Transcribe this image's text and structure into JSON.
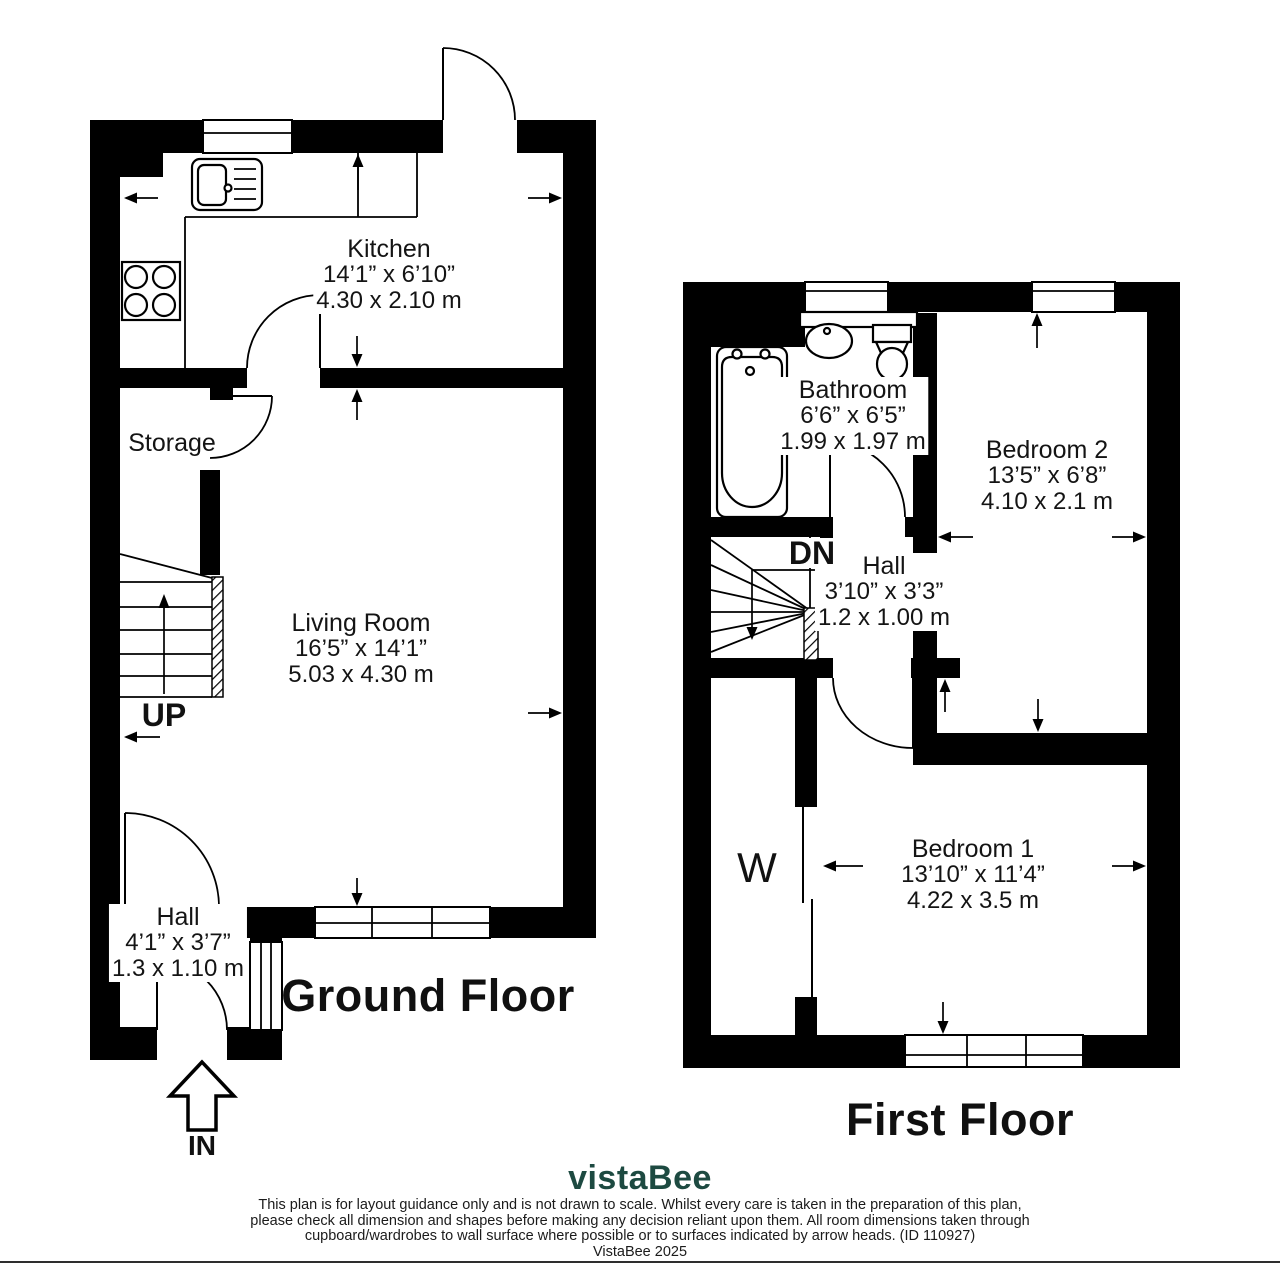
{
  "meta": {
    "background_color": "#ffffff",
    "wall_color": "#000000",
    "text_color": "#141414",
    "logo_color": "#1d4a41"
  },
  "ground_floor": {
    "title": "Ground Floor",
    "stairs_label": "UP",
    "entrance_label": "IN",
    "rooms": {
      "kitchen": {
        "name": "Kitchen",
        "imperial": "14’1” x 6’10”",
        "metric": "4.30 x 2.10 m"
      },
      "storage": {
        "name": "Storage"
      },
      "living_room": {
        "name": "Living Room",
        "imperial": "16’5” x 14’1”",
        "metric": "5.03 x 4.30 m"
      },
      "hall": {
        "name": "Hall",
        "imperial": "4’1” x 3’7”",
        "metric": "1.3 x 1.10 m"
      }
    }
  },
  "first_floor": {
    "title": "First Floor",
    "stairs_label": "DN",
    "wardrobe_label": "W",
    "rooms": {
      "bathroom": {
        "name": "Bathroom",
        "imperial": "6’6” x 6’5”",
        "metric": "1.99 x 1.97 m"
      },
      "bedroom_2": {
        "name": "Bedroom 2",
        "imperial": "13’5” x 6’8”",
        "metric": "4.10 x 2.1 m"
      },
      "hall": {
        "name": "Hall",
        "imperial": "3’10” x 3’3”",
        "metric": "1.2 x 1.00 m"
      },
      "bedroom_1": {
        "name": "Bedroom 1",
        "imperial": "13’10” x 11’4”",
        "metric": "4.22 x 3.5 m"
      }
    }
  },
  "footer": {
    "logo": "vistaBee",
    "disclaimer_line1": "This plan is for layout guidance only and is not drawn to scale. Whilst every care is taken in the preparation of this plan,",
    "disclaimer_line2": "please check all dimension and shapes before making any decision reliant upon them. All room dimensions taken through",
    "disclaimer_line3": "cupboard/wardrobes to wall surface where possible or to surfaces indicated by arrow heads. (ID 110927)",
    "copyright": "VistaBee 2025"
  }
}
